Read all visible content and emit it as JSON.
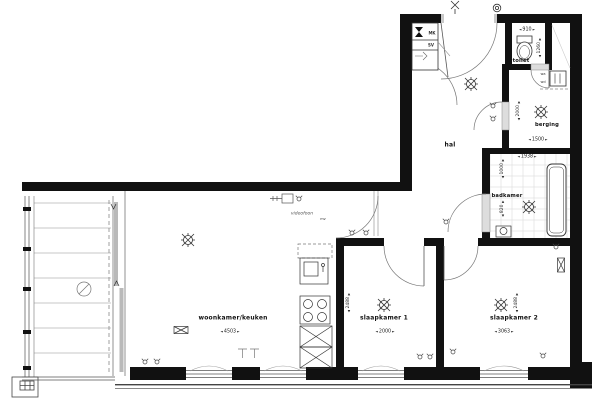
{
  "rooms": [
    {
      "label": "woonkamer/keuken",
      "width_mm": "4503"
    },
    {
      "label": "slaapkamer 1",
      "width_mm": "2000",
      "depth_mm": "2488"
    },
    {
      "label": "slaapkamer 2",
      "width_mm": "3063",
      "depth_mm": "2488"
    },
    {
      "label": "hal"
    },
    {
      "label": "toilet",
      "width_mm": "910",
      "depth_mm": "1260"
    },
    {
      "label": "berging",
      "width_mm": "1500",
      "depth_mm": "2000"
    },
    {
      "label": "badkamer",
      "width_mm": "1938",
      "depth_mm": "1000",
      "depth2_mm": "820"
    }
  ],
  "annotations": {
    "meter_cupboard": "MK",
    "shaft": "SV",
    "intercom": "videofoon",
    "ventilation": "mv",
    "washer": "wa",
    "dryer": "wd"
  },
  "colors": {
    "wall": "#111111",
    "line": "#444444",
    "tile": "#d5d5d5",
    "door_frame": "#c9c9c9"
  }
}
